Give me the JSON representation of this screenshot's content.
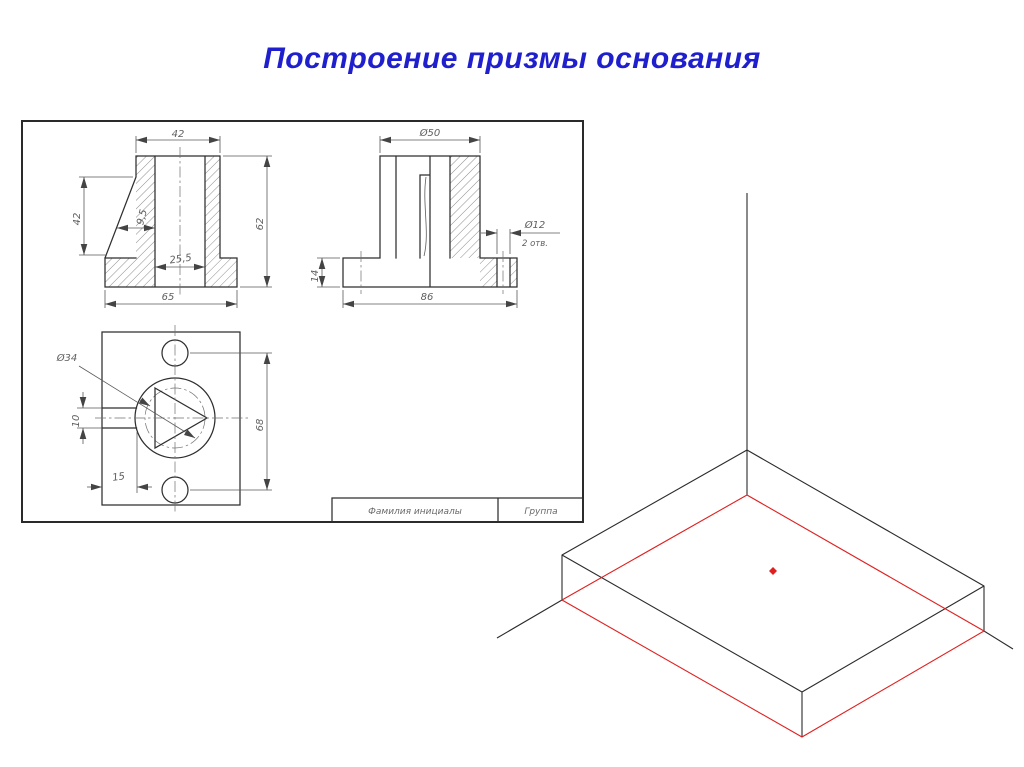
{
  "title": {
    "text": "Построение призмы основания",
    "color": "#1f1fce"
  },
  "sheet": {
    "front_view": {
      "dims": {
        "width_top": "42",
        "height_left": "42",
        "wall": "9,5",
        "hole_width": "25,5",
        "height_total": "62",
        "base_width": "65"
      }
    },
    "side_view": {
      "dims": {
        "dia_top": "Ø50",
        "dia_hole": "Ø12",
        "hole_note": "2 отв.",
        "flange_thickness": "14",
        "base_length": "86"
      }
    },
    "top_view": {
      "dims": {
        "dia_boss": "Ø34",
        "slot_width": "10",
        "slot_offset": "15",
        "hole_span": "68"
      }
    },
    "title_block": {
      "name_label": "Фамилия инициалы",
      "group_label": "Группа"
    }
  },
  "iso_view": {
    "edge_color": "#2b2b2b",
    "base_color": "#e02020"
  }
}
